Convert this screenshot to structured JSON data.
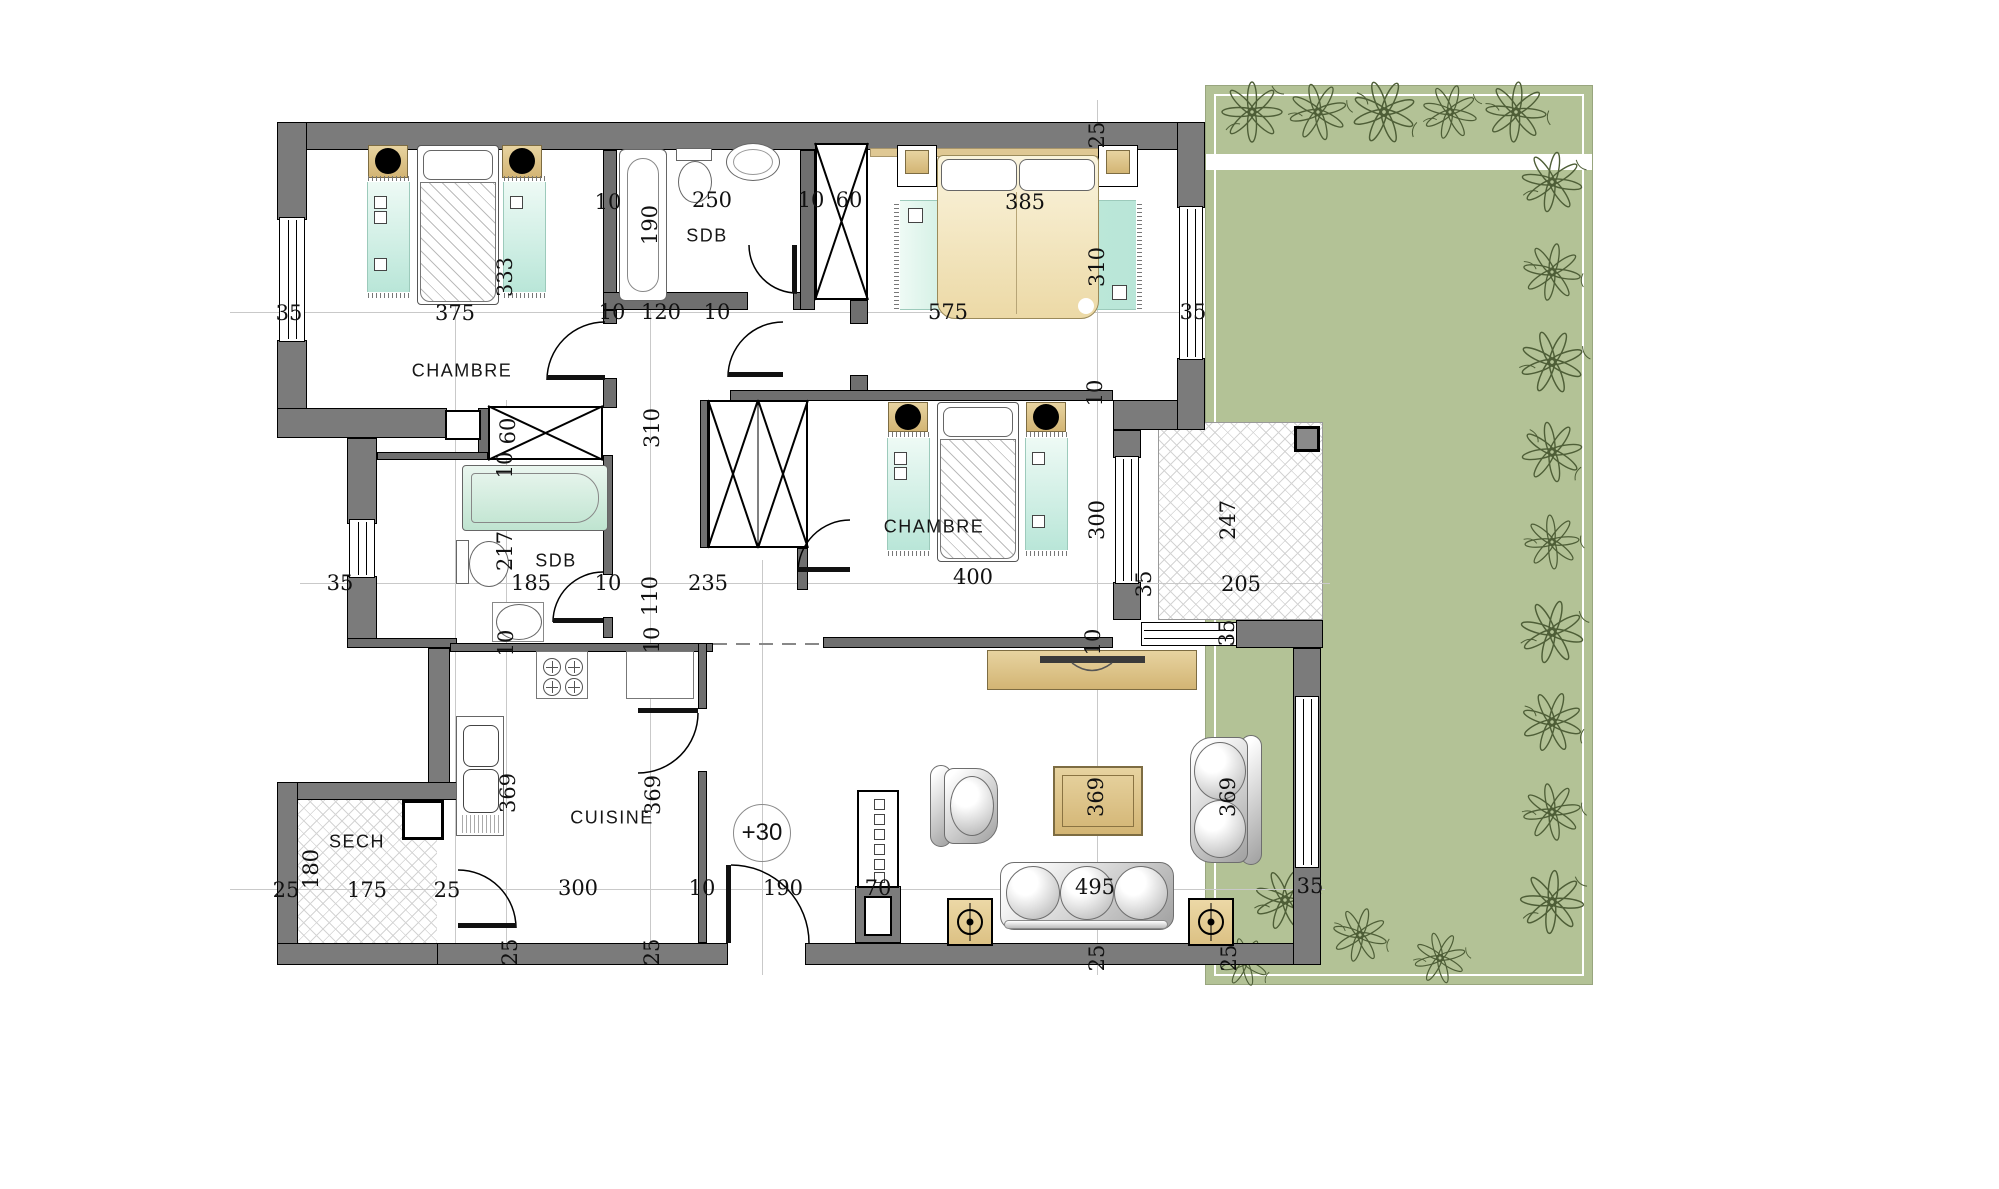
{
  "plan_title": "apartment-floor-plan",
  "colors": {
    "wall": "#7b7b7b",
    "garden": "#b3c296",
    "rug": "#b9e6d8",
    "wood": "#d3b574",
    "cream_bed": "#ecd9a6",
    "hatch_line": "#d4d4d4"
  },
  "rooms": [
    {
      "id": "chambre-1",
      "label": "CHAMBRE",
      "x": 462,
      "y": 371
    },
    {
      "id": "sdb-1",
      "label": "SDB",
      "x": 707,
      "y": 236
    },
    {
      "id": "chambre-2",
      "label": "CHAMBRE",
      "x": 934,
      "y": 527
    },
    {
      "id": "sdb-2",
      "label": "SDB",
      "x": 556,
      "y": 561
    },
    {
      "id": "cuisine",
      "label": "CUISINE",
      "x": 612,
      "y": 818
    },
    {
      "id": "sech",
      "label": "SECH",
      "x": 357,
      "y": 842
    }
  ],
  "level_marker": {
    "text": "+30",
    "x": 762,
    "y": 833
  },
  "dimensions": [
    {
      "text": "35",
      "x": 289,
      "y": 313,
      "o": "h"
    },
    {
      "text": "375",
      "x": 455,
      "y": 313,
      "o": "h"
    },
    {
      "text": "333",
      "x": 505,
      "y": 277,
      "o": "v"
    },
    {
      "text": "10",
      "x": 608,
      "y": 202,
      "o": "h"
    },
    {
      "text": "190",
      "x": 650,
      "y": 225,
      "o": "v"
    },
    {
      "text": "250",
      "x": 712,
      "y": 200,
      "o": "h"
    },
    {
      "text": "10",
      "x": 811,
      "y": 200,
      "o": "h"
    },
    {
      "text": "60",
      "x": 849,
      "y": 200,
      "o": "h"
    },
    {
      "text": "385",
      "x": 1025,
      "y": 202,
      "o": "h"
    },
    {
      "text": "310",
      "x": 1097,
      "y": 267,
      "o": "v"
    },
    {
      "text": "25",
      "x": 1097,
      "y": 135,
      "o": "v"
    },
    {
      "text": "575",
      "x": 948,
      "y": 312,
      "o": "h"
    },
    {
      "text": "35",
      "x": 1193,
      "y": 312,
      "o": "h"
    },
    {
      "text": "10",
      "x": 612,
      "y": 312,
      "o": "h"
    },
    {
      "text": "120",
      "x": 661,
      "y": 312,
      "o": "h"
    },
    {
      "text": "10",
      "x": 717,
      "y": 312,
      "o": "h"
    },
    {
      "text": "60",
      "x": 508,
      "y": 431,
      "o": "v"
    },
    {
      "text": "10",
      "x": 505,
      "y": 465,
      "o": "v"
    },
    {
      "text": "310",
      "x": 652,
      "y": 428,
      "o": "v"
    },
    {
      "text": "10",
      "x": 1095,
      "y": 393,
      "o": "v"
    },
    {
      "text": "217",
      "x": 505,
      "y": 551,
      "o": "v"
    },
    {
      "text": "185",
      "x": 531,
      "y": 583,
      "o": "h"
    },
    {
      "text": "10",
      "x": 608,
      "y": 583,
      "o": "h"
    },
    {
      "text": "110",
      "x": 650,
      "y": 596,
      "o": "v"
    },
    {
      "text": "235",
      "x": 708,
      "y": 583,
      "o": "h"
    },
    {
      "text": "35",
      "x": 340,
      "y": 583,
      "o": "h"
    },
    {
      "text": "400",
      "x": 973,
      "y": 577,
      "o": "h"
    },
    {
      "text": "300",
      "x": 1097,
      "y": 520,
      "o": "v"
    },
    {
      "text": "247",
      "x": 1228,
      "y": 520,
      "o": "v"
    },
    {
      "text": "205",
      "x": 1241,
      "y": 584,
      "o": "h"
    },
    {
      "text": "35",
      "x": 1144,
      "y": 584,
      "o": "v"
    },
    {
      "text": "35",
      "x": 1227,
      "y": 633,
      "o": "v"
    },
    {
      "text": "10",
      "x": 1093,
      "y": 642,
      "o": "v"
    },
    {
      "text": "10",
      "x": 506,
      "y": 643,
      "o": "v"
    },
    {
      "text": "10",
      "x": 652,
      "y": 640,
      "o": "v"
    },
    {
      "text": "369",
      "x": 508,
      "y": 793,
      "o": "v"
    },
    {
      "text": "369",
      "x": 653,
      "y": 795,
      "o": "v"
    },
    {
      "text": "180",
      "x": 311,
      "y": 869,
      "o": "v"
    },
    {
      "text": "25",
      "x": 286,
      "y": 890,
      "o": "h"
    },
    {
      "text": "175",
      "x": 367,
      "y": 890,
      "o": "h"
    },
    {
      "text": "25",
      "x": 447,
      "y": 890,
      "o": "h"
    },
    {
      "text": "300",
      "x": 578,
      "y": 888,
      "o": "h"
    },
    {
      "text": "10",
      "x": 702,
      "y": 888,
      "o": "h"
    },
    {
      "text": "190",
      "x": 783,
      "y": 888,
      "o": "h"
    },
    {
      "text": "70",
      "x": 878,
      "y": 888,
      "o": "h"
    },
    {
      "text": "495",
      "x": 1095,
      "y": 887,
      "o": "h"
    },
    {
      "text": "369",
      "x": 1096,
      "y": 797,
      "o": "v"
    },
    {
      "text": "369",
      "x": 1228,
      "y": 797,
      "o": "v"
    },
    {
      "text": "35",
      "x": 1310,
      "y": 886,
      "o": "h"
    },
    {
      "text": "25",
      "x": 510,
      "y": 952,
      "o": "v"
    },
    {
      "text": "25",
      "x": 652,
      "y": 952,
      "o": "v"
    },
    {
      "text": "25",
      "x": 1097,
      "y": 958,
      "o": "v"
    },
    {
      "text": "25",
      "x": 1229,
      "y": 958,
      "o": "v"
    }
  ]
}
